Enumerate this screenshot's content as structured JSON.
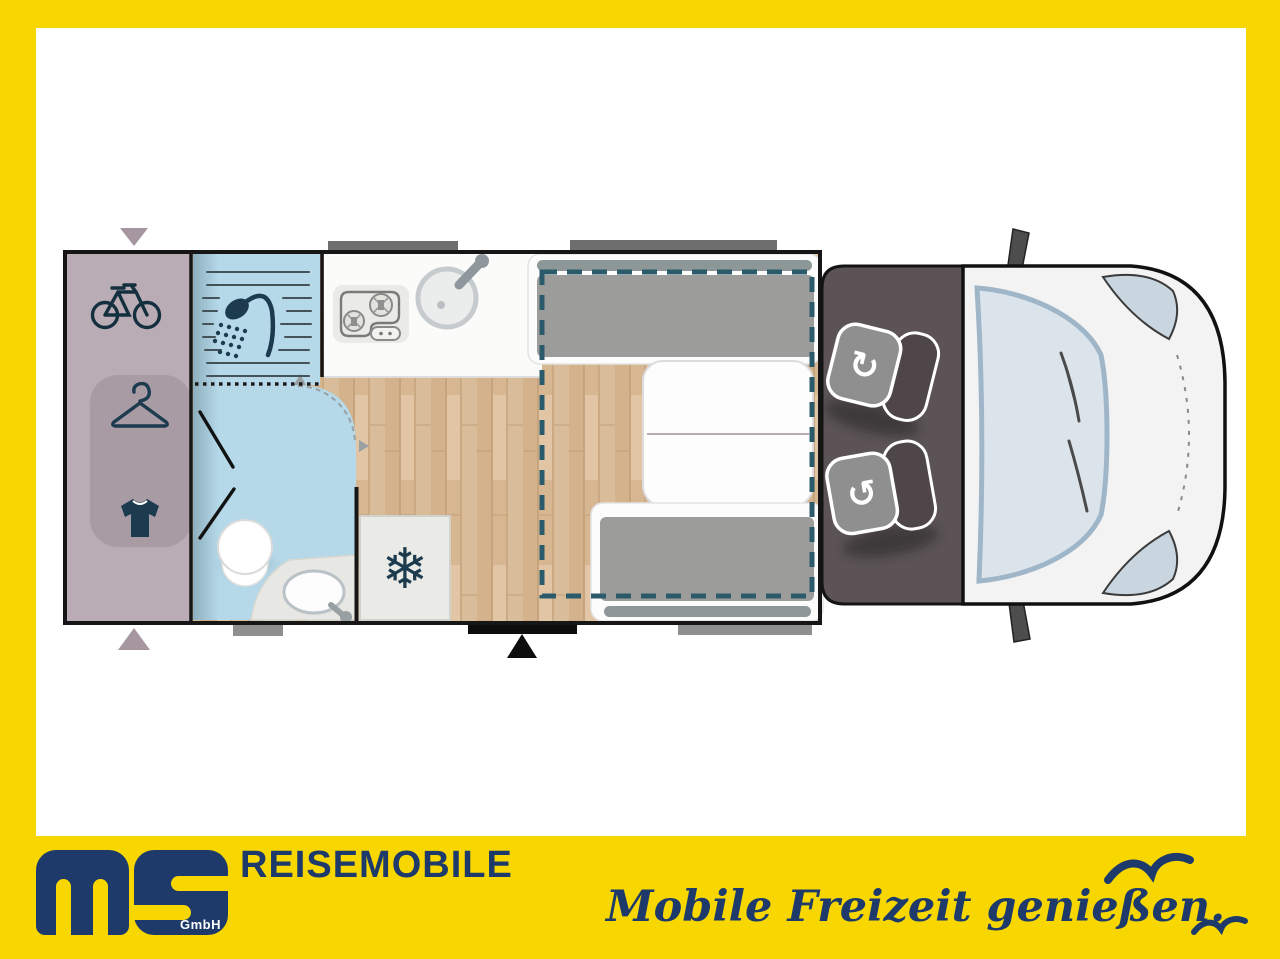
{
  "brand": {
    "gmbh": "GmbH",
    "title": "REISEMOBILE",
    "slogan": "Mobile Freizeit genießen."
  },
  "icons": {
    "snowflake": "❄",
    "rotate_cw": "↻",
    "rotate_ccw": "↺"
  },
  "colors": {
    "accent_yellow": "#F8D700",
    "brand_navy": "#1D3A6B",
    "garage_mauve": "#B9ACB5",
    "wet_room_blue": "#B5D9E9",
    "wood_floor": "#D8B894",
    "cab_dark": "#5B5356",
    "bed_outline_teal": "#2B5A6A",
    "icon_navy": "#1C3B4E"
  }
}
